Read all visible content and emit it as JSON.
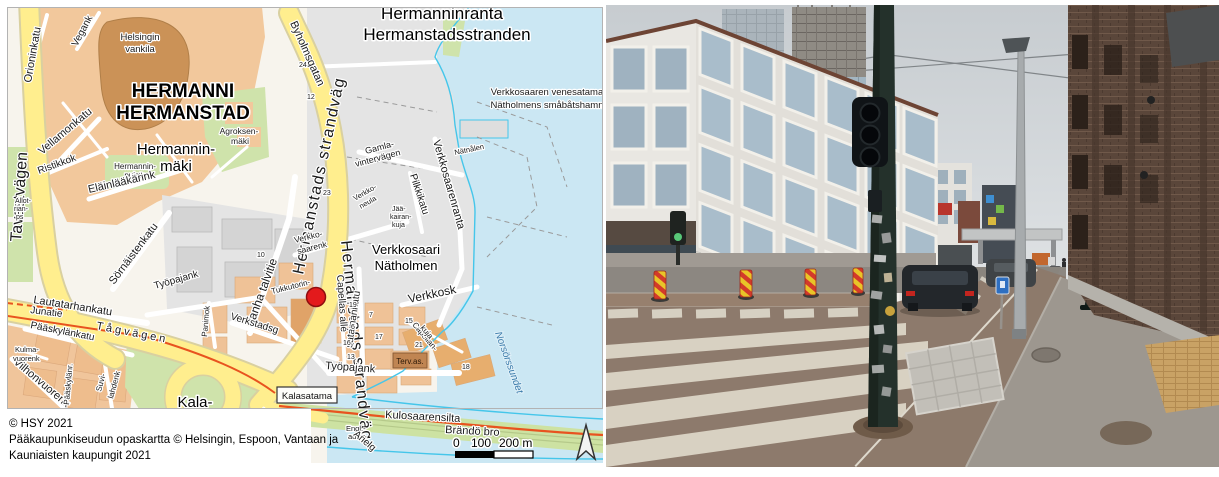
{
  "map": {
    "region_title": [
      "Hermanninranta",
      "Hermanstadsstranden"
    ],
    "district": [
      "HERMANNI",
      "HERMANSTAD"
    ],
    "labels": {
      "helsingin_vankila": [
        "Helsingin",
        "vankila"
      ],
      "hermanninmaki": [
        "Hermannin-",
        "mäki"
      ],
      "agroksenmaki": [
        "Agroksen-",
        "mäki"
      ],
      "hermanninpuisto": [
        "Hermannin-",
        "puisto"
      ],
      "venesatama": [
        "Verkkosaaren venesatama",
        "Nätholmens småbåtshamn"
      ],
      "verkkosaari": [
        "Verkkosaari",
        "Nätholmen"
      ],
      "kalasatama_area": [
        "Kala-",
        "satama"
      ],
      "gamlavintervagen": [
        "Gamla-",
        "vintervägen"
      ],
      "verkkosaarenk": [
        "Verkko-",
        "saarenk"
      ],
      "verkkoneula": [
        "Verkko-",
        "neula"
      ],
      "jaakairankuja": [
        "Jää-",
        "kairan-",
        "kuja"
      ],
      "capellankuja": [
        "Capellan-",
        "kuja"
      ],
      "kulmavuorenk": [
        "Kulma-",
        "vuorenk"
      ],
      "suvilahdenk": [
        "Suvi-",
        "lahdenk"
      ],
      "englaukio": [
        "Engl.-",
        "aukio"
      ],
      "allotrianps": [
        "Allot-",
        "rian-",
        "ps"
      ],
      "strandvag": "Hermanstads strandväg",
      "byholmsgatan": "Byholmsgatan",
      "vanha_talvitie": "Vanha talvitie",
      "tukkutorin": "Tukkutorin-",
      "tyopajank": "Työpajank",
      "sornaistenkatu": "Sörnäistenkatu",
      "elainlaakarink": "Eläinlääkärink",
      "ristikkok": "Ristikkok",
      "vellamonkatu": "Vellamonkatu",
      "orioninkatu": "Orioninkatu",
      "vegank": "Vegank",
      "tavastvagen": "Tavastvägen",
      "lautatarhankatu": "Lautatarhankatu",
      "junatie": "Junatie",
      "tagvagen": "Tågvägen",
      "paaskylankatu": "Pääskylänkatu",
      "vilhonvuorenk": "Vilhonvuorenk",
      "paaskylanr": "Pääskylänr.",
      "kalasatama_box": "Kalasatama",
      "verkstadsg": "Verkstadsg",
      "panimok": "Panimok",
      "tervas": "Terv.as.",
      "capellas_alle": "Capellas allé",
      "satamankatu": "satamankatu",
      "verkkosk": "Verkkosk",
      "pilkkikatu": "Pilkkikatu",
      "verkkosaarenranta": "Verkkosaarenranta",
      "natnalen": "Nätnålen",
      "norsorssundet": "Norsörssundet",
      "kulosaarensilta": "Kulosaarensilta",
      "brandobro": "Brändö bro",
      "arielg": "Arielg",
      "leonh": "Leonh."
    },
    "house_numbers": [
      "24",
      "19",
      "12",
      "15",
      "17",
      "13",
      "7",
      "14",
      "10",
      "6",
      "16",
      "18",
      "21",
      "23"
    ],
    "scale": {
      "t0": "0",
      "t100": "100",
      "t200": "200 m"
    },
    "attribution": [
      "© HSY 2021",
      "Pääkaupunkiseudun opaskartta © Helsingin, Espoon, Vantaan ja",
      "Kauniaisten kaupungit 2021"
    ],
    "colors": {
      "marker": "#e31a1c",
      "road_yellow": "#ffee8e",
      "water": "#cbe7f3",
      "railway": "#e8531f"
    }
  },
  "photo": {
    "description": "Street-level photo: white apartment block and construction towers on the left, dark traffic-light pole with stickers in the foreground, zebra crossing on brown asphalt, grey sidewalk and dark brick building on the right, overcast sky.",
    "colors": {
      "sky": "#ccd2d6",
      "brick": "#5a463a",
      "asphalt_near": "#8d7a6c",
      "asphalt_far": "#8c8781",
      "zebra": "#dcd5c6",
      "scooter_teal": "#31a08c",
      "sign_blue": "#2e6fc1"
    }
  }
}
